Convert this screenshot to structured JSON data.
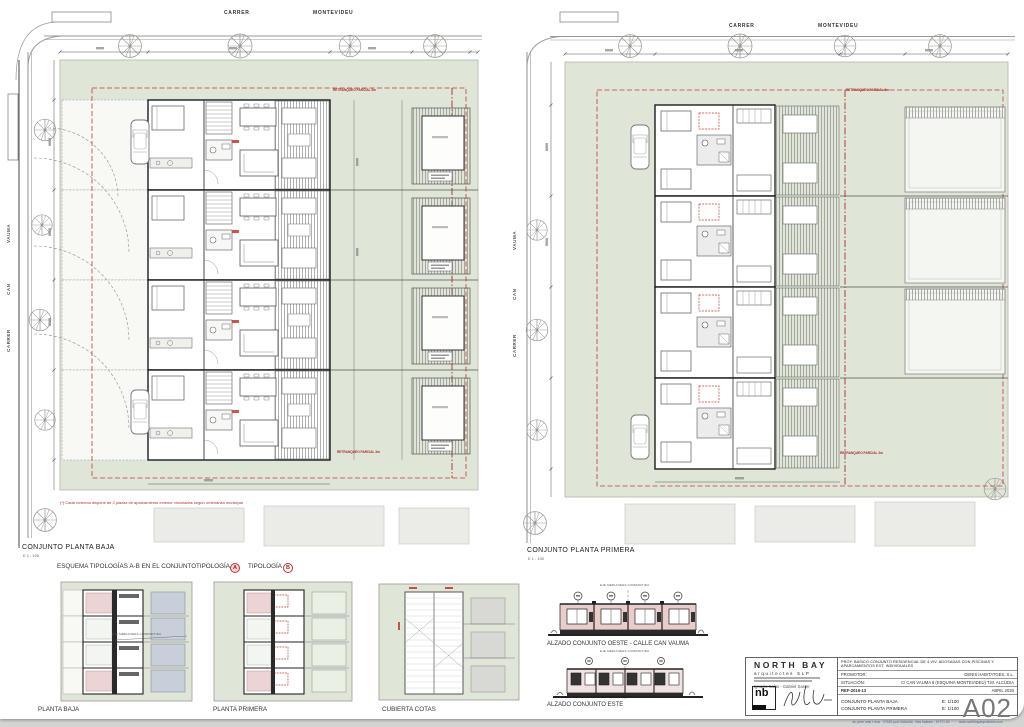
{
  "sheet": {
    "number": "A02"
  },
  "streets": {
    "carrer": "CARRER",
    "montevideu": "MONTEVIDEU",
    "can": "CAN",
    "vauma": "VAUMA"
  },
  "plan_left": {
    "title": "CONJUNTO PLANTA BAJA",
    "scale": "E 1 : 100",
    "footnote": "(*) Cada vivienda dispone de 2 plazas de aparcamiento exterior vinculadas según ordenanza municipal",
    "setback_note": "RETRANQUEO PARCIAL 3m"
  },
  "plan_right": {
    "title": "CONJUNTO PLANTA PRIMERA",
    "scale": "E 1 : 100",
    "setback_note": "RETRANQUEO PARCIAL 3m"
  },
  "schema": {
    "heading": "ESQUEMA TIPOLOGÍAS A-B EN EL CONJUNTO",
    "tipologia_a": "TIPOLOGÍA -",
    "badge_a": "A",
    "tipologia_b": "TIPOLOGÍA -",
    "badge_b": "B"
  },
  "small_plans": {
    "planta_baja": "PLANTA BAJA",
    "planta_primera": "PLANTA PRIMERA",
    "cubierta": "CUBIERTA COTAS"
  },
  "elevations": {
    "eje": "EJE MEDIANERA COMPARTIDA",
    "west": "ALZADO CONJUNTO OESTE - CALLE CAN VAUMA",
    "east": "ALZADO CONJUNTO ESTE"
  },
  "titleblock": {
    "firm": "NORTH BAY",
    "firm_sub": "arquitectes SLP",
    "architects": "Ignacio Salas - Gabriel Sastre",
    "logo": "nb",
    "project": "PROY. BÁSICO CONJUNTO RESIDENCIAL DE 4 VIV. ADOSADAS CON PISCINAS Y APARCAMIENTOS EXT. INDIVIDUALES",
    "promotor_label": "PROMOTOR:",
    "promotor": "DENIS HABITATGES, S.L.",
    "situacion_label": "SITUACIÓN:",
    "situacion": "C/ CAN VAUMA 6 (ESQUINA MONTEVIDEU) T.M. ALCÚDIA",
    "ref": "REF-2019-13",
    "date": "ABRIL 2020",
    "sheets": [
      {
        "name": "CONJUNTO PLANTA BAJA",
        "scale": "E: 1/100"
      },
      {
        "name": "CONJUNTO PLANTA PRIMERA",
        "scale": "E: 1/100"
      }
    ],
    "number": "A02",
    "contact": "av. pere mas i reus · 07400 port d'alcúdia · illes balears · t/f 971 54 ·· ·· · www.northbayarquitectes.com"
  }
}
